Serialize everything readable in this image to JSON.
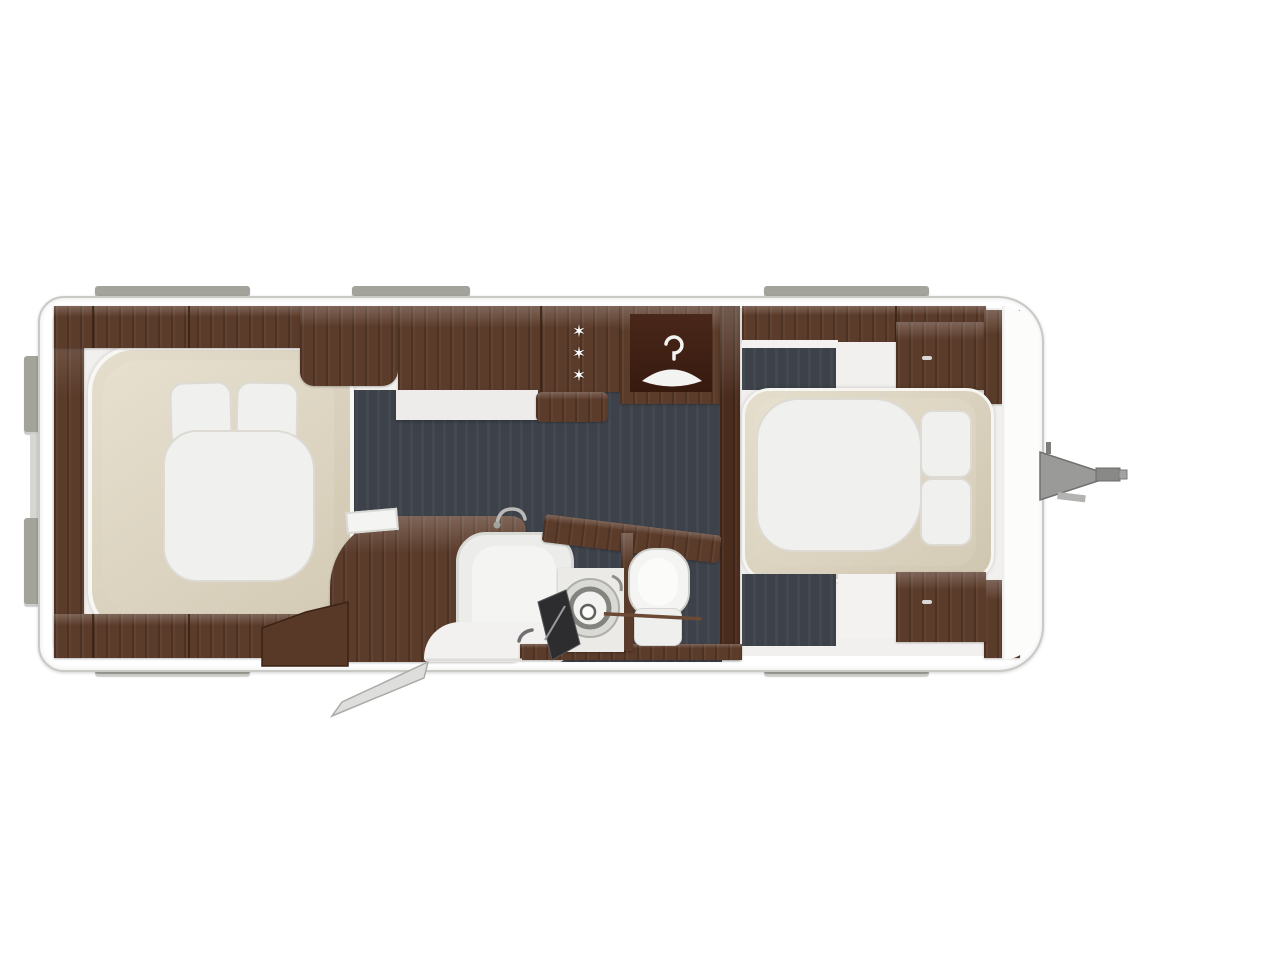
{
  "scene": {
    "name": "caravan-floor-plan",
    "view": "top-down",
    "background": "#ffffff"
  },
  "colors": {
    "wood": "#5b3b2a",
    "wood_dark": "#46281b",
    "floor": "#3d424a",
    "bed_frame": "#d9d1bf",
    "bedding_white": "#f0f0ee",
    "body_wall": "#ffffff",
    "body_outline": "#c9c9c6",
    "window_tab_gray": "#a3a39b",
    "hitch_metal": "#9a9a98"
  },
  "rooms": {
    "rear_bedroom": "island-bed-rear",
    "kitchen": "kitchen-galley",
    "bathroom": "washroom-with-toilet-and-sink",
    "wardrobe": "hanging-wardrobe",
    "front_bedroom": "front-bed"
  },
  "icons": {
    "freezer_star": "✶",
    "hanger": "clothes-hanger-icon",
    "toilet": "toilet-fixture",
    "sink": "round-basin",
    "shower": "shower-tray",
    "hitch": "tow-hitch"
  }
}
